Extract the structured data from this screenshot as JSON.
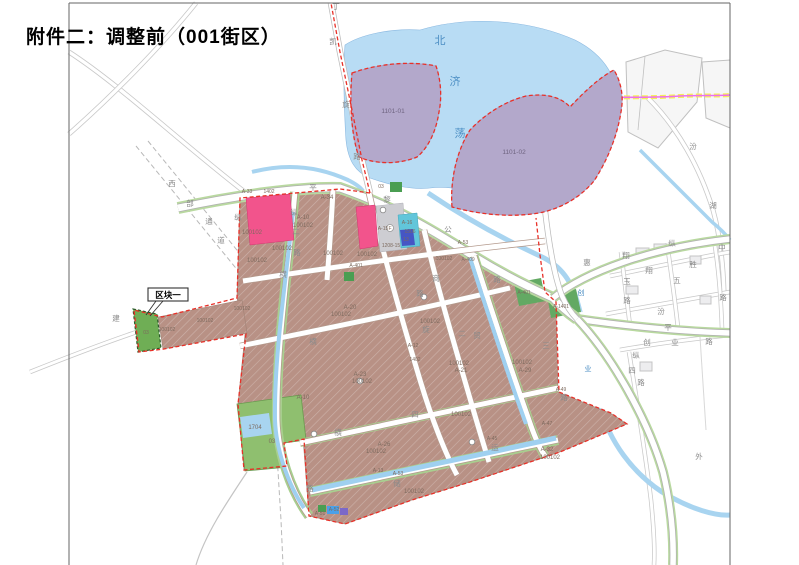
{
  "title": "附件二：调整前（001街区）",
  "callout": {
    "label": "区块一"
  },
  "colors": {
    "water": "#b8dcf4",
    "canal": "#9fd0f0",
    "purple_parcel": "#b3a8cb",
    "residential_brown": "#b89185",
    "pink_parcel": "#f2548c",
    "cyan_parcel": "#62c6da",
    "deep_blue_parcel": "#4656c4",
    "gray_parcel": "#cdcdd2",
    "green_parcel": "#8fbf6f",
    "dark_green_parcel": "#4a9e52",
    "road_green_edge": "#b9d9a0",
    "boundary_red": "#e83028",
    "boundary_yellow": "#f5ee58",
    "boundary_magenta": "#ee6ef0"
  },
  "map": {
    "water_name": "北济荡",
    "labels": [
      {
        "t": "北",
        "x": 441,
        "y": 44,
        "c": "water"
      },
      {
        "t": "济",
        "x": 456,
        "y": 85,
        "c": "water"
      },
      {
        "t": "荡",
        "x": 461,
        "y": 137,
        "c": "water"
      },
      {
        "t": "1101-01",
        "x": 393,
        "y": 113,
        "c": "purp"
      },
      {
        "t": "1101-02",
        "x": 514,
        "y": 154,
        "c": "purp"
      },
      {
        "t": "丁",
        "x": 336,
        "y": 9,
        "c": "road"
      },
      {
        "t": "凯",
        "x": 333,
        "y": 44,
        "c": "road"
      },
      {
        "t": "旋",
        "x": 346,
        "y": 107,
        "c": "road"
      },
      {
        "t": "路",
        "x": 357,
        "y": 159,
        "c": "road"
      },
      {
        "t": "西",
        "x": 172,
        "y": 186,
        "c": "road"
      },
      {
        "t": "部",
        "x": 190,
        "y": 206,
        "c": "road"
      },
      {
        "t": "通",
        "x": 209,
        "y": 224,
        "c": "road"
      },
      {
        "t": "道",
        "x": 221,
        "y": 243,
        "c": "road"
      },
      {
        "t": "建",
        "x": 116,
        "y": 321,
        "c": "road"
      },
      {
        "t": "平",
        "x": 313,
        "y": 190,
        "c": "road"
      },
      {
        "t": "黎",
        "x": 387,
        "y": 202,
        "c": "road"
      },
      {
        "t": "公",
        "x": 448,
        "y": 232,
        "c": "road"
      },
      {
        "t": "路",
        "x": 497,
        "y": 282,
        "c": "road"
      },
      {
        "t": "纵",
        "x": 294,
        "y": 215,
        "c": "road"
      },
      {
        "t": "二",
        "x": 296,
        "y": 234,
        "c": "road"
      },
      {
        "t": "路",
        "x": 297,
        "y": 255,
        "c": "road"
      },
      {
        "t": "纵",
        "x": 238,
        "y": 220,
        "c": "road"
      },
      {
        "t": "横",
        "x": 283,
        "y": 277,
        "c": "road"
      },
      {
        "t": "路",
        "x": 420,
        "y": 296,
        "c": "road"
      },
      {
        "t": "商",
        "x": 436,
        "y": 281,
        "c": "road"
      },
      {
        "t": "贸",
        "x": 477,
        "y": 338,
        "c": "road"
      },
      {
        "t": "旋",
        "x": 426,
        "y": 332,
        "c": "road"
      },
      {
        "t": "二",
        "x": 462,
        "y": 336,
        "c": "road"
      },
      {
        "t": "三",
        "x": 546,
        "y": 348,
        "c": "road"
      },
      {
        "t": "横",
        "x": 313,
        "y": 344,
        "c": "road"
      },
      {
        "t": "横",
        "x": 338,
        "y": 435,
        "c": "road"
      },
      {
        "t": "四",
        "x": 415,
        "y": 417,
        "c": "road"
      },
      {
        "t": "路",
        "x": 564,
        "y": 400,
        "c": "road"
      },
      {
        "t": "储",
        "x": 397,
        "y": 486,
        "c": "road"
      },
      {
        "t": "路",
        "x": 310,
        "y": 491,
        "c": "road"
      },
      {
        "t": "运",
        "x": 495,
        "y": 450,
        "c": "road"
      },
      {
        "t": "外",
        "x": 699,
        "y": 459,
        "c": "road"
      },
      {
        "t": "惠",
        "x": 587,
        "y": 265,
        "c": "road"
      },
      {
        "t": "汾",
        "x": 693,
        "y": 149,
        "c": "road"
      },
      {
        "t": "湖",
        "x": 713,
        "y": 208,
        "c": "road"
      },
      {
        "t": "纵",
        "x": 672,
        "y": 246,
        "c": "road"
      },
      {
        "t": "中",
        "x": 722,
        "y": 250,
        "c": "road"
      },
      {
        "t": "翔",
        "x": 626,
        "y": 258,
        "c": "road"
      },
      {
        "t": "玉",
        "x": 627,
        "y": 284,
        "c": "road"
      },
      {
        "t": "路",
        "x": 627,
        "y": 303,
        "c": "road"
      },
      {
        "t": "翔",
        "x": 649,
        "y": 273,
        "c": "road"
      },
      {
        "t": "五",
        "x": 677,
        "y": 283,
        "c": "road"
      },
      {
        "t": "胜",
        "x": 693,
        "y": 267,
        "c": "road"
      },
      {
        "t": "汾",
        "x": 661,
        "y": 314,
        "c": "road"
      },
      {
        "t": "平",
        "x": 668,
        "y": 330,
        "c": "road"
      },
      {
        "t": "创",
        "x": 647,
        "y": 345,
        "c": "road"
      },
      {
        "t": "业",
        "x": 675,
        "y": 345,
        "c": "road"
      },
      {
        "t": "路",
        "x": 709,
        "y": 344,
        "c": "road"
      },
      {
        "t": "纵",
        "x": 636,
        "y": 358,
        "c": "road"
      },
      {
        "t": "四",
        "x": 632,
        "y": 373,
        "c": "road"
      },
      {
        "t": "路",
        "x": 641,
        "y": 385,
        "c": "road"
      },
      {
        "t": "路",
        "x": 723,
        "y": 300,
        "c": "road"
      },
      {
        "t": "创",
        "x": 581,
        "y": 295,
        "c": "wroad"
      },
      {
        "t": "业",
        "x": 588,
        "y": 371,
        "c": "wroad"
      },
      {
        "t": "A-33",
        "x": 247,
        "y": 193,
        "c": "psm"
      },
      {
        "t": "1402",
        "x": 269,
        "y": 193,
        "c": "psm"
      },
      {
        "t": "A-34",
        "x": 327,
        "y": 199,
        "c": "parcel"
      },
      {
        "t": "A-10",
        "x": 303,
        "y": 219,
        "c": "parcel"
      },
      {
        "t": "100102",
        "x": 303,
        "y": 227,
        "c": "parcel"
      },
      {
        "t": "100102",
        "x": 252,
        "y": 234,
        "c": "parcel"
      },
      {
        "t": "100102",
        "x": 257,
        "y": 262,
        "c": "parcel"
      },
      {
        "t": "100102",
        "x": 282,
        "y": 250,
        "c": "parcel"
      },
      {
        "t": "100102",
        "x": 333,
        "y": 255,
        "c": "parcel"
      },
      {
        "t": "100102",
        "x": 367,
        "y": 256,
        "c": "parcel"
      },
      {
        "t": "1208-15",
        "x": 391,
        "y": 247,
        "c": "psm"
      },
      {
        "t": "A-15",
        "x": 383,
        "y": 230,
        "c": "psm"
      },
      {
        "t": "A-16",
        "x": 407,
        "y": 224,
        "c": "psm"
      },
      {
        "t": "1506",
        "x": 410,
        "y": 233,
        "c": "psm"
      },
      {
        "t": "13",
        "x": 406,
        "y": 241,
        "c": "psm"
      },
      {
        "t": "F",
        "x": 390,
        "y": 230,
        "c": "psm"
      },
      {
        "t": "03",
        "x": 381,
        "y": 188,
        "c": "psm"
      },
      {
        "t": "100102",
        "x": 167,
        "y": 331,
        "c": "psm"
      },
      {
        "t": "100102",
        "x": 205,
        "y": 322,
        "c": "psm"
      },
      {
        "t": "100102",
        "x": 242,
        "y": 310,
        "c": "psm"
      },
      {
        "t": "03",
        "x": 146,
        "y": 334,
        "c": "psm"
      },
      {
        "t": "A-20",
        "x": 350,
        "y": 309,
        "c": "parcel"
      },
      {
        "t": "100102",
        "x": 341,
        "y": 316,
        "c": "parcel"
      },
      {
        "t": "A-23",
        "x": 360,
        "y": 376,
        "c": "parcel"
      },
      {
        "t": "100102",
        "x": 362,
        "y": 383,
        "c": "parcel"
      },
      {
        "t": "A-10",
        "x": 303,
        "y": 399,
        "c": "parcel"
      },
      {
        "t": "100102",
        "x": 430,
        "y": 323,
        "c": "parcel"
      },
      {
        "t": "100102",
        "x": 459,
        "y": 365,
        "c": "parcel"
      },
      {
        "t": "A-21",
        "x": 461,
        "y": 372,
        "c": "parcel"
      },
      {
        "t": "100102",
        "x": 522,
        "y": 364,
        "c": "parcel"
      },
      {
        "t": "A-29",
        "x": 525,
        "y": 372,
        "c": "parcel"
      },
      {
        "t": "100102",
        "x": 444,
        "y": 260,
        "c": "psm"
      },
      {
        "t": "A-409",
        "x": 468,
        "y": 261,
        "c": "psm"
      },
      {
        "t": "A-53",
        "x": 463,
        "y": 244,
        "c": "psm"
      },
      {
        "t": "A-401",
        "x": 356,
        "y": 267,
        "c": "psm"
      },
      {
        "t": "A-401",
        "x": 524,
        "y": 294,
        "c": "psm"
      },
      {
        "t": "A-1401",
        "x": 561,
        "y": 308,
        "c": "psm"
      },
      {
        "t": "A-12",
        "x": 413,
        "y": 347,
        "c": "psm"
      },
      {
        "t": "1402",
        "x": 415,
        "y": 361,
        "c": "psm"
      },
      {
        "t": "A-49",
        "x": 561,
        "y": 391,
        "c": "psm"
      },
      {
        "t": "A-47",
        "x": 547,
        "y": 425,
        "c": "psm"
      },
      {
        "t": "A-45",
        "x": 492,
        "y": 440,
        "c": "psm"
      },
      {
        "t": "A-32",
        "x": 547,
        "y": 451,
        "c": "parcel"
      },
      {
        "t": "100102",
        "x": 550,
        "y": 459,
        "c": "parcel"
      },
      {
        "t": "A-26",
        "x": 384,
        "y": 446,
        "c": "parcel"
      },
      {
        "t": "100102",
        "x": 376,
        "y": 453,
        "c": "parcel"
      },
      {
        "t": "A-13",
        "x": 378,
        "y": 472,
        "c": "psm"
      },
      {
        "t": "A-53",
        "x": 398,
        "y": 475,
        "c": "psm"
      },
      {
        "t": "100102",
        "x": 414,
        "y": 493,
        "c": "parcel"
      },
      {
        "t": "A-51",
        "x": 320,
        "y": 515,
        "c": "psm"
      },
      {
        "t": "A-52",
        "x": 334,
        "y": 511,
        "c": "psm"
      },
      {
        "t": "1704",
        "x": 255,
        "y": 429,
        "c": "parcel"
      },
      {
        "t": "03",
        "x": 272,
        "y": 443,
        "c": "parcel"
      },
      {
        "t": "100102",
        "x": 461,
        "y": 416,
        "c": "parcel"
      }
    ],
    "markers": [
      {
        "x": 383,
        "y": 210
      },
      {
        "x": 360,
        "y": 381
      },
      {
        "x": 314,
        "y": 434
      },
      {
        "x": 472,
        "y": 442
      },
      {
        "x": 424,
        "y": 297
      }
    ]
  }
}
